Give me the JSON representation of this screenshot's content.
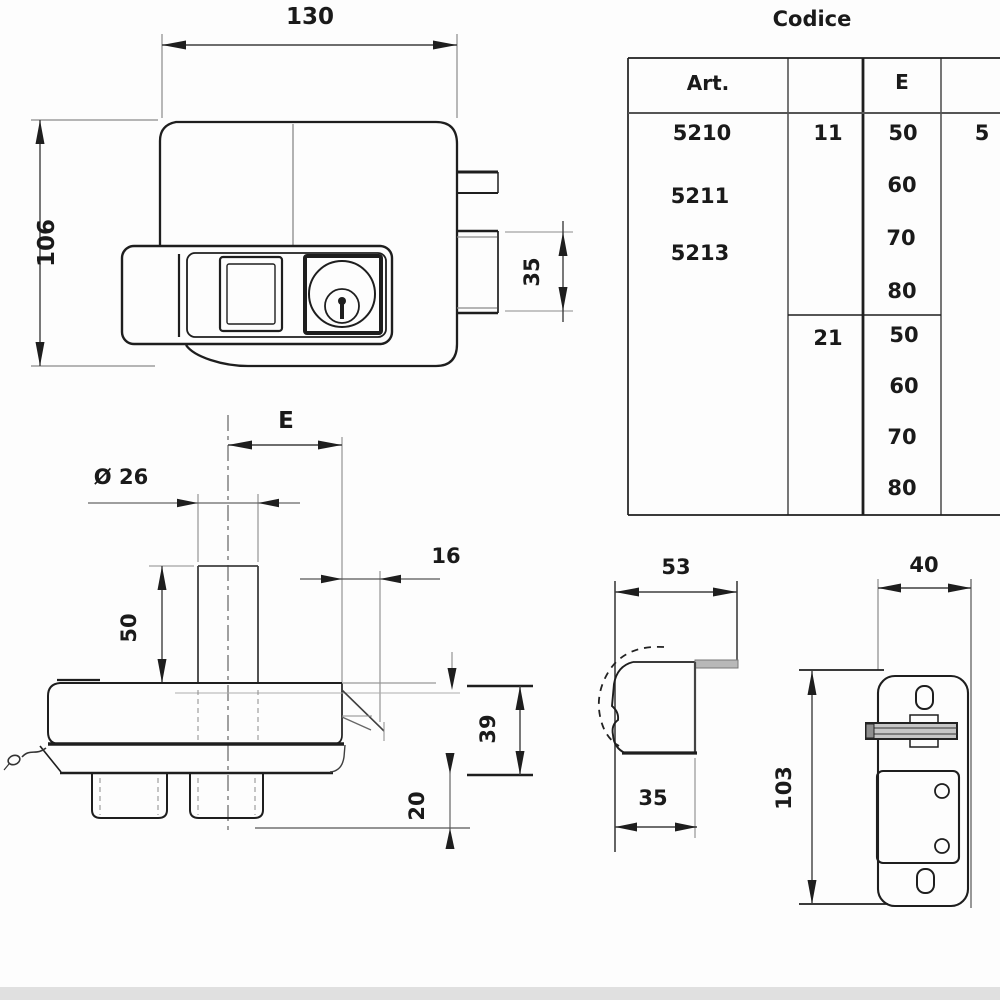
{
  "table": {
    "title": "Codice",
    "col_headers": {
      "art": "Art.",
      "e": "E"
    },
    "articles": [
      "5210",
      "5211",
      "5213"
    ],
    "groups": [
      {
        "key": "11",
        "values": [
          "50",
          "60",
          "70",
          "80"
        ]
      },
      {
        "key": "21",
        "values": [
          "50",
          "60",
          "70",
          "80"
        ]
      }
    ],
    "extra_value": "5"
  },
  "front_view": {
    "dim_width": "130",
    "dim_height": "106",
    "dim_latch": "35"
  },
  "top_view": {
    "dim_e": "E",
    "dim_diameter": "Ø 26",
    "dim_cyl_height": "50",
    "dim_backset": "16",
    "dim_body_depth": "39",
    "dim_feet": "20"
  },
  "strike_side_view": {
    "dim_depth": "53",
    "dim_width": "35"
  },
  "strike_front_view": {
    "dim_width": "40",
    "dim_height": "103"
  },
  "colors": {
    "line": "#1e1e1e",
    "thin_line": "#8a8a8a",
    "gray_fill": "#b8b8b8",
    "background": "#fdfdfd"
  }
}
